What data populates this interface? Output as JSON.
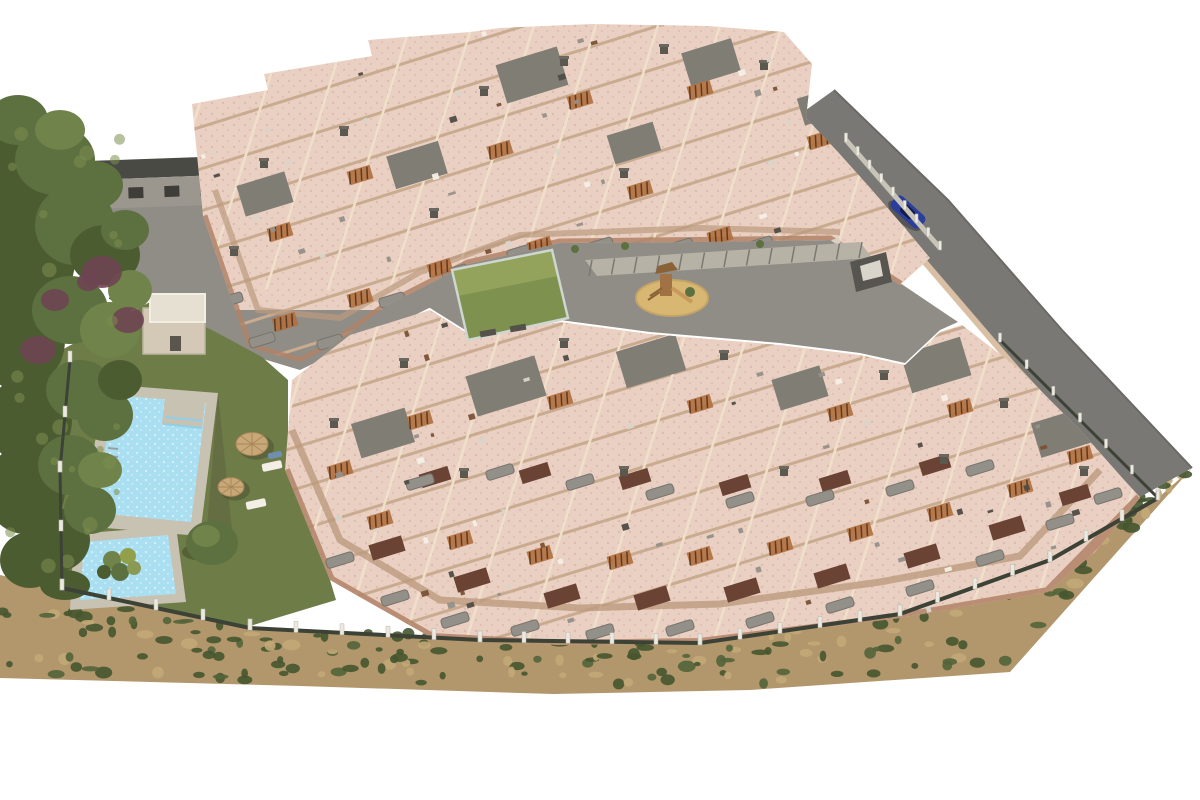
{
  "image": {
    "kind": "aerial-3d-architectural-render",
    "subject": "new-build apartment complex with stepped rooftop terraces, communal swimming pool, lawns, playground and perimeter fencing",
    "background": "white",
    "elements": [
      {
        "name": "tree-cluster",
        "description": "dense green trees with purple flowering shrubs along the left edge"
      },
      {
        "name": "neighboring-building",
        "description": "grey row building with dark roof behind the site, top left"
      },
      {
        "name": "upper-apartment-block",
        "description": "diagonal band of terraced apartments with pink rooftop terraces"
      },
      {
        "name": "lower-apartment-block",
        "description": "larger diagonal band of terraced apartments with balconies and brick recesses"
      },
      {
        "name": "central-courtyard",
        "description": "grey paved courtyard with walkway, dark feature wall and planters"
      },
      {
        "name": "playground",
        "description": "round sand pit with wooden climbing frame and slide"
      },
      {
        "name": "sports-court",
        "description": "green mini padel/play court with glass fencing"
      },
      {
        "name": "swimming-pool",
        "description": "rectangular communal pool with corner step platform and grey surround"
      },
      {
        "name": "kids-pool",
        "description": "small secondary splash pool"
      },
      {
        "name": "parasols",
        "description": "two straw parasols with sun loungers on the lawn"
      },
      {
        "name": "service-hut",
        "description": "small flat-roofed utility building beside the pool garden"
      },
      {
        "name": "access-road",
        "description": "grey road running along the upper-right boundary"
      },
      {
        "name": "car",
        "description": "single blue car parked on the access road"
      },
      {
        "name": "perimeter-fence",
        "description": "dark mesh fence with light posts around the plot"
      },
      {
        "name": "scrubland",
        "description": "sandy scrub strip with dark green bushes along the lower boundary"
      }
    ]
  },
  "colors": {
    "background": "#ffffff",
    "tree_dark": "#4c5c31",
    "tree_mid": "#5d7040",
    "tree_light": "#70834a",
    "bush_purple": "#6e4452",
    "lawn": "#6e7c48",
    "scrub_sand": "#b2966c",
    "scrub_bush": "#45552f",
    "pool_deck": "#c8c2b2",
    "pool_water": "#aadff2",
    "pool_water_light": "#d8f0fa",
    "wall_light": "#e9d6bd",
    "wall_mid": "#d9c0a4",
    "wall_shadow": "#bb9a7d",
    "terrace_pink": "#ead0c3",
    "terrace_speckle": "#ddbcae",
    "parapet_line": "#c9ab90",
    "divider_line": "#f0e0ca",
    "facade_edge": "#b08366",
    "roof_gray": "#807d75",
    "roof_dark": "#5b584f",
    "brick_brown": "#6b4334",
    "balcony_gray": "#93908a",
    "stair_wood": "#b06f3e",
    "road_gray": "#7a7874",
    "paving_gray": "#908d86",
    "playground_sand": "#d8b773",
    "play_wood": "#a07244",
    "court_green": "#7e914f",
    "court_green_light": "#93a35c",
    "neighbor_roof": "#4a4a45",
    "neighbor_wall": "#9b978e",
    "fence_dark": "#3d4237",
    "fence_post": "#ece9e1",
    "car_blue": "#2c3e9c",
    "furniture_white": "#f4efe6"
  }
}
